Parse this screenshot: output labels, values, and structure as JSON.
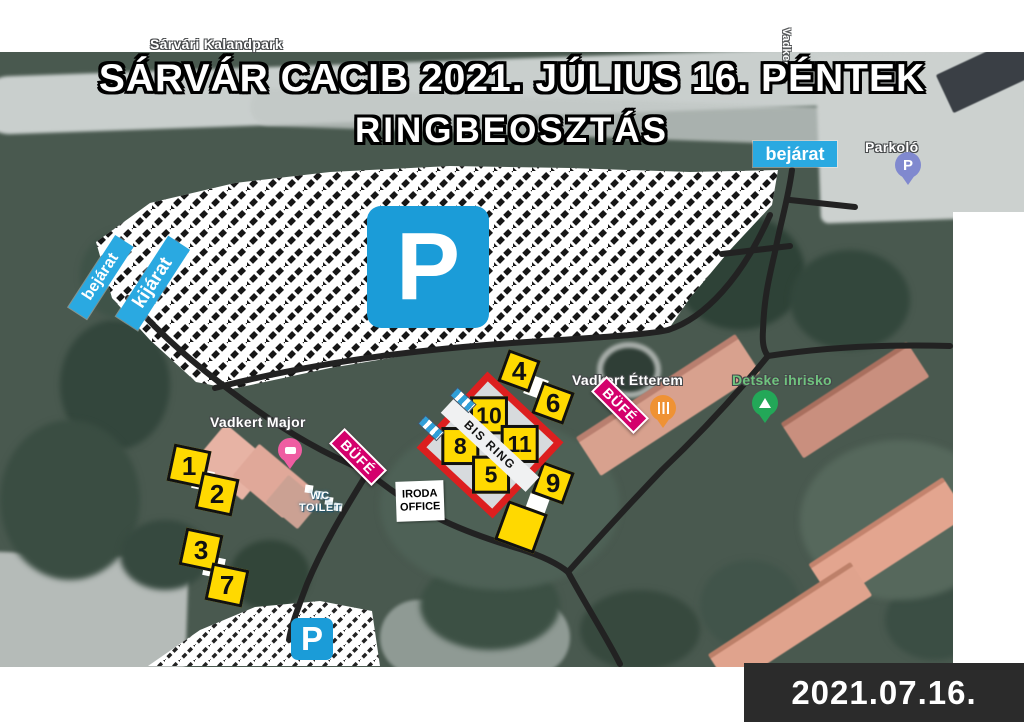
{
  "title": {
    "line1": "SÁRVÁR CACIB 2021. JÚLIUS 16. PÉNTEK",
    "line2": "RINGBEOSZTÁS"
  },
  "date_badge": {
    "text": "2021.07.16."
  },
  "signs": {
    "entrance_left": "bejárat",
    "exit_left": "kijárat",
    "entrance_right": "bejárat",
    "parking_big": "P",
    "parking_small": "P"
  },
  "bis_ring": {
    "label": "BIS RING",
    "cells": [
      "10",
      "11",
      "8",
      "5"
    ]
  },
  "ring_markers": {
    "r1": "1",
    "r2": "2",
    "r3": "3",
    "r7": "7",
    "r4": "4",
    "r6": "6",
    "r9": "9"
  },
  "facilities": {
    "office": {
      "line1": "IRODA",
      "line2": "OFFICE"
    },
    "wc": {
      "line1": "WC",
      "line2": "TOILET"
    },
    "buffet_left": "BÜFÉ",
    "buffet_right": "BÜFÉ"
  },
  "map_labels": {
    "adventure_park": "Sárvári Kalandpark",
    "farm": "Vadkert Major",
    "restaurant": "Vadkert Étterem",
    "playground": "Detske ihrisko",
    "street": "Vadkert u.",
    "parking": "Parkoló",
    "parking_pin": "P"
  },
  "colors": {
    "sign_blue": "#1b9cd8",
    "label_blue": "#2aa9e1",
    "marker_yellow": "#ffd900",
    "ring_red": "#dc1f1f",
    "buffet_magenta": "#d4006c",
    "date_bg": "#2b2b2b",
    "road_black": "#222222"
  }
}
